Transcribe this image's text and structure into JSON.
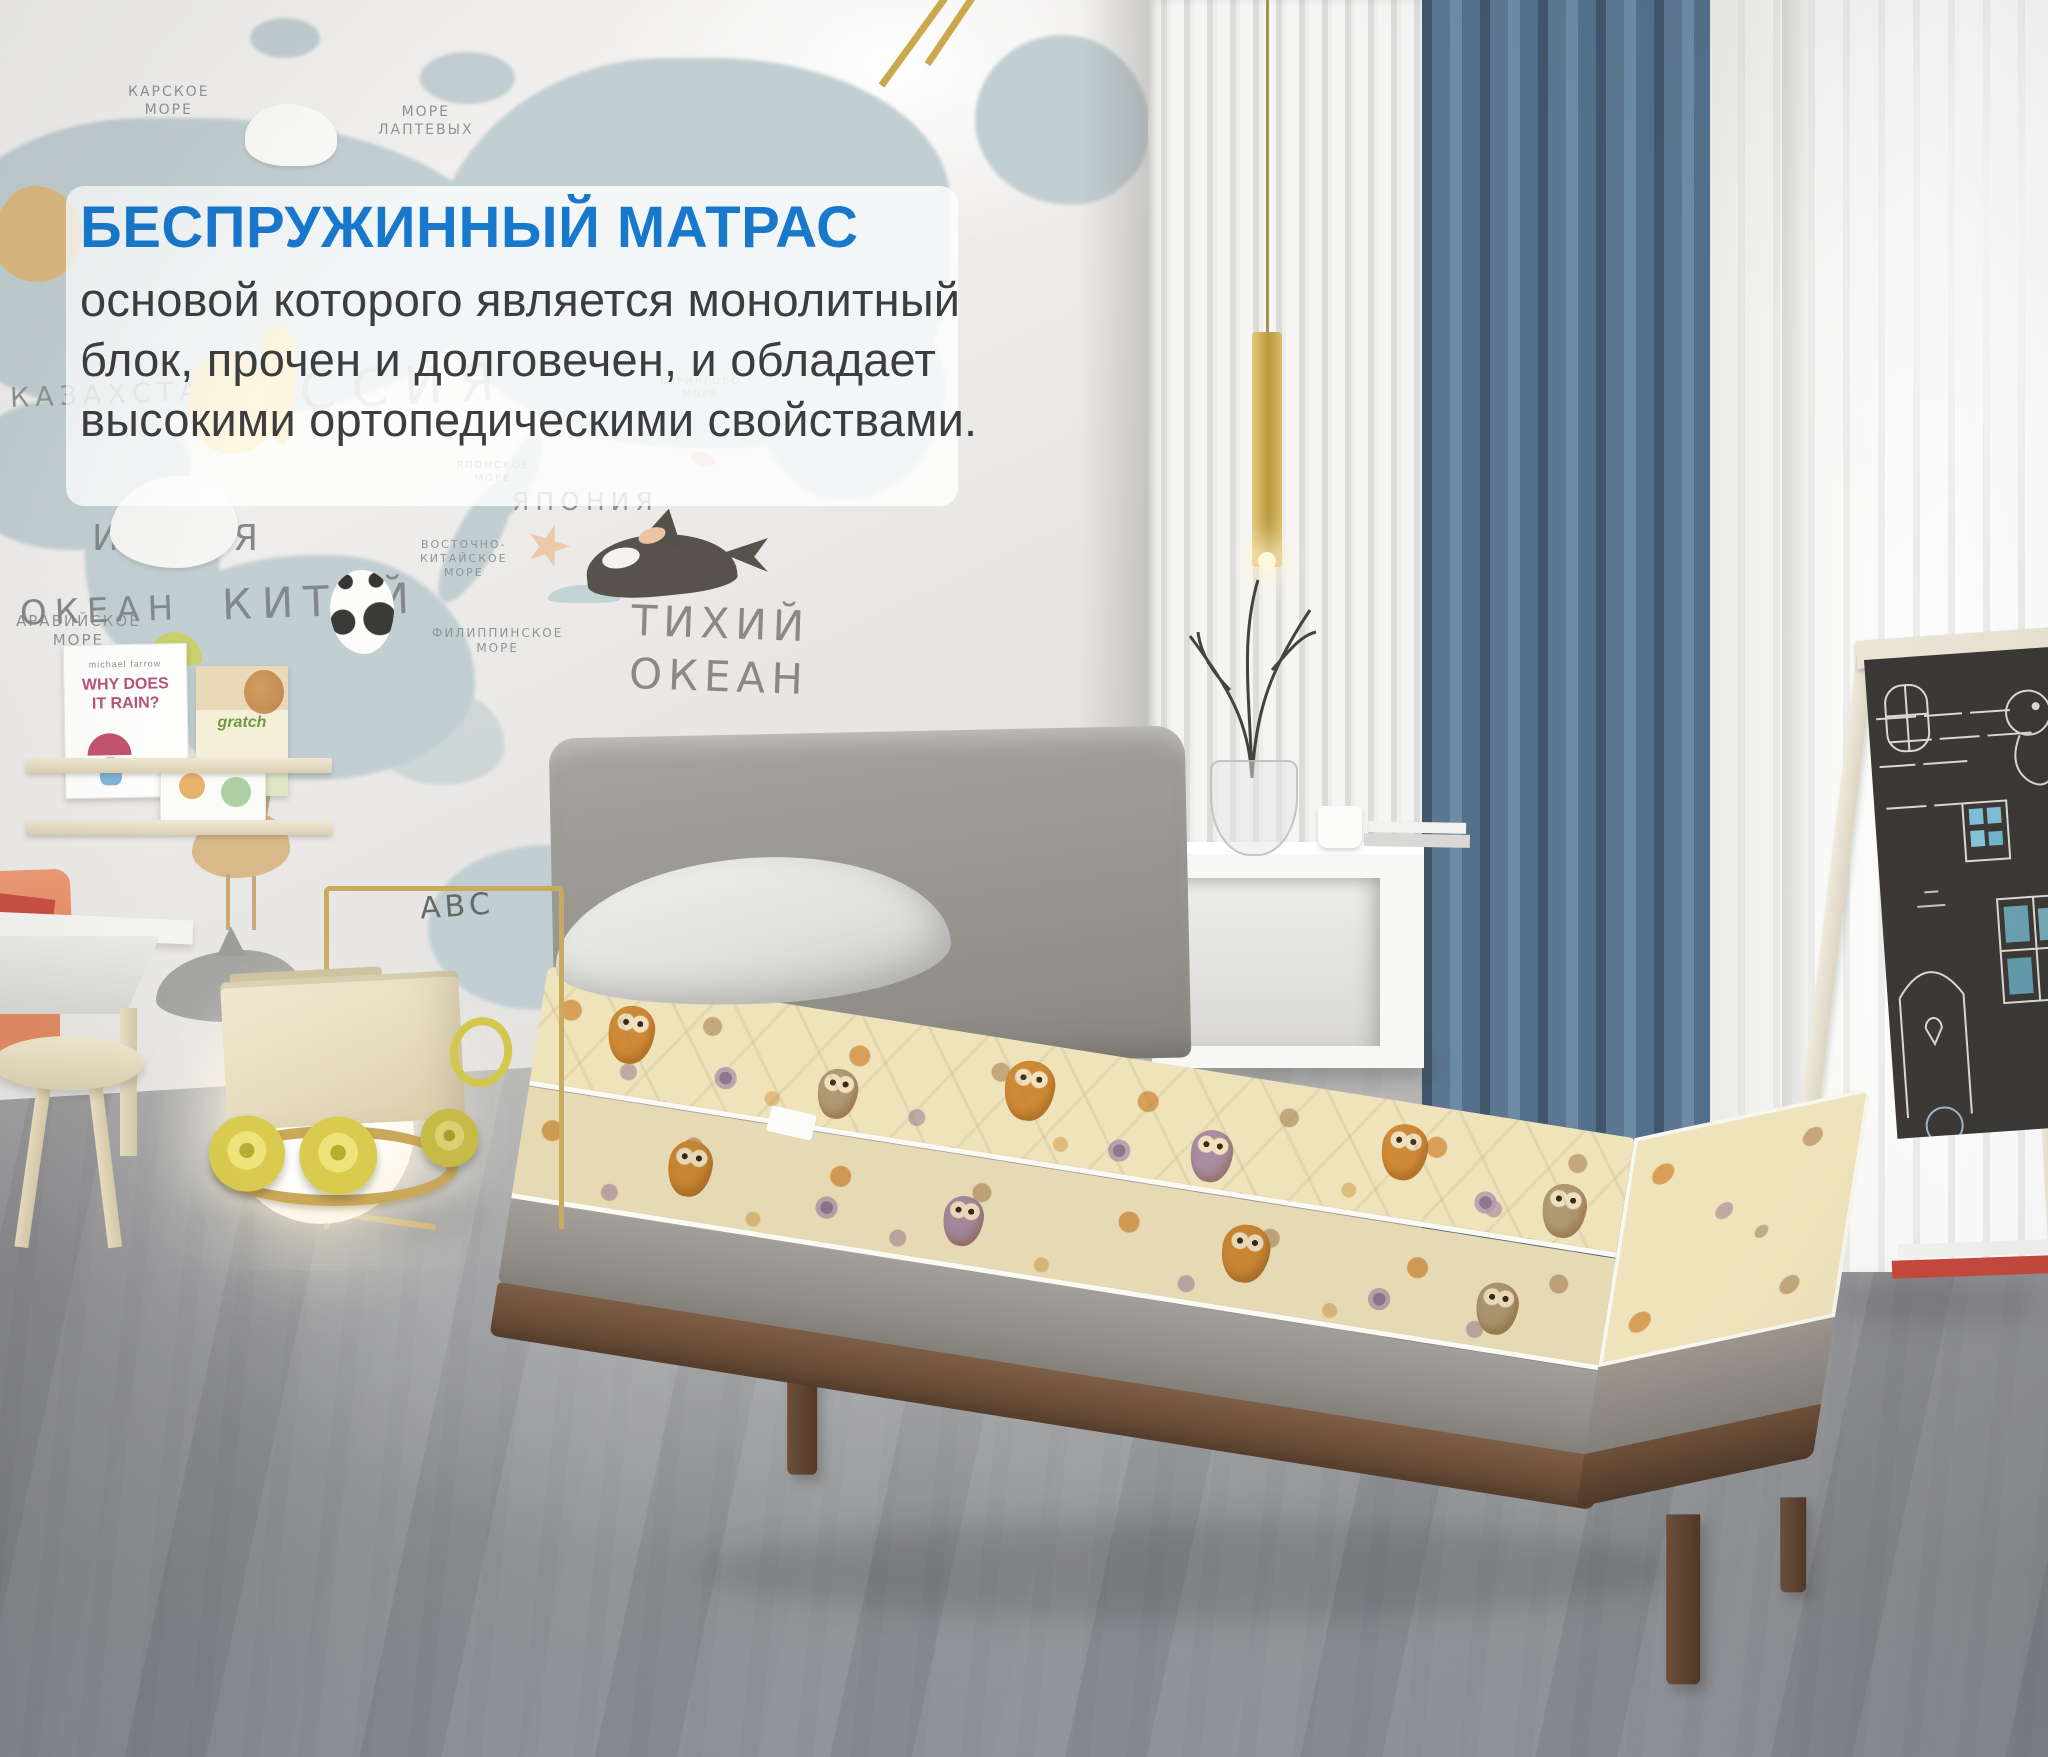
{
  "overlay": {
    "title": "БЕСПРУЖИННЫЙ МАТРАС",
    "line1": "основой которого является монолитный",
    "line2": "блок, прочен и долговечен, и обладает",
    "line3": "высокими ортопедическими свойствами.",
    "title_color": "#1878cc",
    "text_color": "#3d3d3f",
    "panel_bg": "rgba(255,255,255,0.80)"
  },
  "map": {
    "labels": {
      "karskoe": "КАРСКОЕ\nМОРЕ",
      "laptevyh": "МОРЕ\nЛАПТЕВЫХ",
      "rossiya": "РОССИЯ",
      "kazahstan": "КАЗАХСТАН",
      "kitay": "КИТАЙ",
      "indiya": "ИНДИЯ",
      "yaponiya": "ЯПОНИЯ",
      "aravijskoe": "АРАВИЙСКОЕ\nМОРЕ",
      "yaponskoe": "ЯПОНСКОЕ\nМОРЕ",
      "beringovo": "БЕРИНГОВО\nМОРЕ",
      "vostochno": "ВОСТОЧНО-\nКИТАЙСКОЕ\nМОРЕ",
      "filippinskoe": "ФИЛИППИНСКОЕ\nМОРЕ",
      "tihiy_okean": "ТИХИЙ\nОКЕАН",
      "okean": "ОКЕАН",
      "abc": "АВС"
    }
  },
  "bookshelf": {
    "book1_author": "michael farrow",
    "book1_title": "WHY DOES\nIT RAIN?",
    "book2_title": "gratch"
  },
  "palette": {
    "accent_blue": "#1878cc",
    "curtain_blue": "#5d7790",
    "mattress_cream": "#efe3bc",
    "owl_orange": "#cf8a35",
    "bed_wood": "#6b4e38",
    "platform_gray": "#8f8b85",
    "headboard_gray": "#97948f",
    "brass": "#c9ab5f",
    "wheel_yellow": "#d8cb4e",
    "chalkboard_dark": "#3b3835",
    "floor_gray": "#96979a",
    "map_land": "#c2cfd2"
  }
}
